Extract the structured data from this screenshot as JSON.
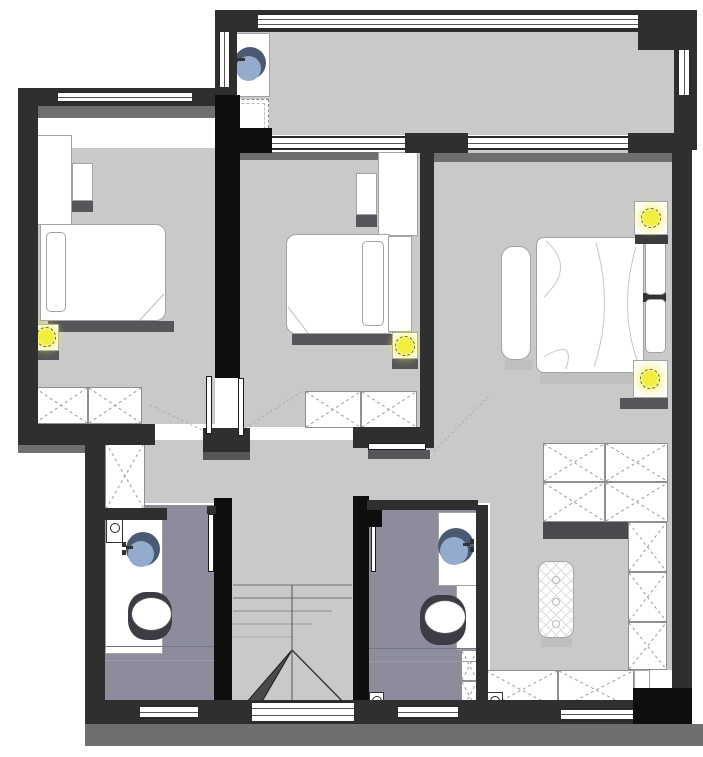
{
  "colors": {
    "wall": "#2f2f2f",
    "wall_black": "#0e0e0e",
    "floor": "#c9c9c9",
    "bathroom_floor": "#8d8c9c",
    "outer_shadow": "#6f6f6f",
    "furniture_shadow": "#55555a",
    "furniture_outline": "#a3a3a3",
    "window_frame": "#2a2a2a",
    "window_glass_line": "#555555",
    "lamp_yellow": "#f2ee3e",
    "sink_dark": "#4a5a72",
    "sink_light": "#94abce",
    "stair_line": "#7a7a7a"
  },
  "plan": {
    "rooms": [
      {
        "name": "balcony-laundry",
        "fixtures": [
          "laundry-sink",
          "washing-machine",
          "window-top",
          "window-left",
          "window-right"
        ]
      },
      {
        "name": "bedroom-left",
        "fixtures": [
          "double-bed",
          "pillow",
          "desk",
          "shelf",
          "nightstand-lamp",
          "dresser-x2",
          "window",
          "sliding-door"
        ]
      },
      {
        "name": "bedroom-middle",
        "fixtures": [
          "double-bed",
          "pillow",
          "wardrobe",
          "shelf",
          "nightstand-lamp",
          "dresser-x2",
          "window",
          "sliding-door"
        ]
      },
      {
        "name": "master-bedroom",
        "fixtures": [
          "double-bed",
          "pillow-x2",
          "bench",
          "nightstand-lamp-x2",
          "wardrobe-x4",
          "window"
        ]
      },
      {
        "name": "hallway",
        "fixtures": [
          "closet",
          "door-swing-marks"
        ]
      },
      {
        "name": "bathroom-left",
        "fixtures": [
          "vanity-sink",
          "toilet",
          "floor-drain",
          "sliding-door",
          "window"
        ]
      },
      {
        "name": "bathroom-middle",
        "fixtures": [
          "vanity-sink",
          "toilet",
          "closet-x2",
          "floor-drain",
          "sliding-door",
          "window"
        ]
      },
      {
        "name": "staircase",
        "fixtures": [
          "steps",
          "winder-arrow",
          "window"
        ]
      },
      {
        "name": "living-area",
        "fixtures": [
          "quilted-rug",
          "closet-column-x3",
          "bottom-cabinets",
          "floor-drain",
          "window"
        ]
      }
    ]
  }
}
